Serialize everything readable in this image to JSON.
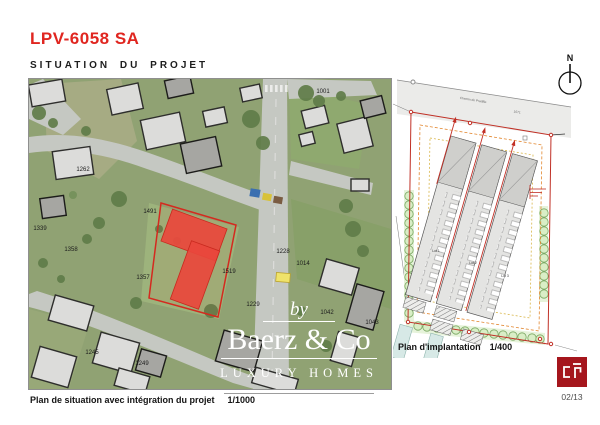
{
  "header": {
    "title": "LPV-6058 SA",
    "subtitle": "SITUATION DU PROJET"
  },
  "map": {
    "caption": "Plan de situation avec intégration du projet",
    "scale": "1/1000",
    "parcel_labels": [
      {
        "t": "1262",
        "x": 54,
        "y": 92
      },
      {
        "t": "1001",
        "x": 294,
        "y": 14
      },
      {
        "t": "1491",
        "x": 121,
        "y": 134
      },
      {
        "t": "1339",
        "x": 11,
        "y": 151
      },
      {
        "t": "1358",
        "x": 42,
        "y": 172
      },
      {
        "t": "1357",
        "x": 114,
        "y": 200
      },
      {
        "t": "1519",
        "x": 200,
        "y": 194
      },
      {
        "t": "1228",
        "x": 254,
        "y": 174
      },
      {
        "t": "1014",
        "x": 274,
        "y": 186
      },
      {
        "t": "1229",
        "x": 224,
        "y": 227
      },
      {
        "t": "1042",
        "x": 298,
        "y": 235
      },
      {
        "t": "1043",
        "x": 343,
        "y": 245
      },
      {
        "t": "1245",
        "x": 63,
        "y": 275
      },
      {
        "t": "1249",
        "x": 113,
        "y": 286
      }
    ],
    "watermark": {
      "by": "by",
      "name": "Baerz & Co",
      "tagline": "LUXURY HOMES"
    }
  },
  "plan": {
    "caption": "Plan d'implantation",
    "scale": "1/400",
    "north_label": "N",
    "lot_labels": [
      {
        "t": "Lot 1",
        "x": 43,
        "y": 184
      },
      {
        "t": "Lot 2",
        "x": 80,
        "y": 196
      },
      {
        "t": "Lot 3",
        "x": 112,
        "y": 209
      }
    ],
    "drawing_labels": [
      {
        "t": "Chemin de Pradille",
        "x": 80,
        "y": 33,
        "r": 9
      },
      {
        "t": "1071",
        "x": 124,
        "y": 45,
        "r": 9
      }
    ]
  },
  "footer": {
    "page": "02/13",
    "logo_text": "cp"
  },
  "colors": {
    "accent_red": "#e02620",
    "parcel_red": "#e9473c",
    "logo_red": "#a5161d",
    "tree_green": "#7aa862"
  }
}
